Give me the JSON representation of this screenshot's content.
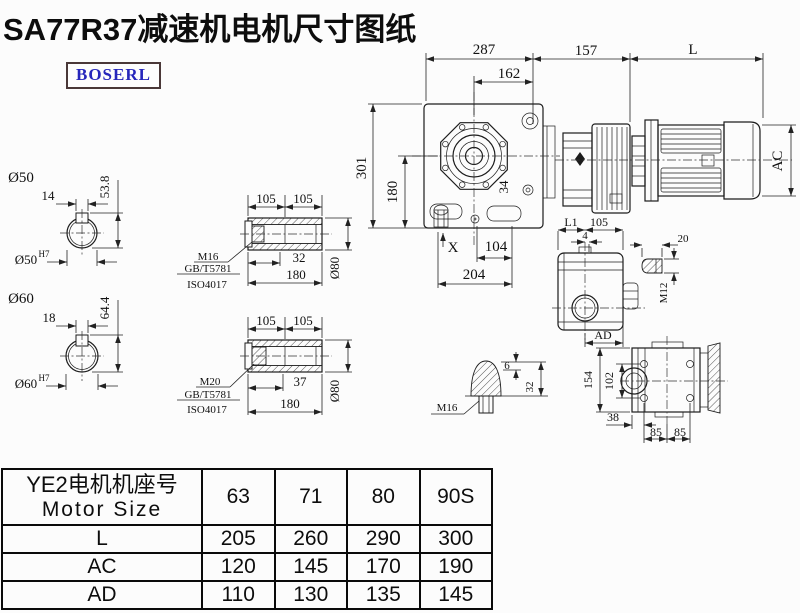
{
  "title": "SA77R37减速机电机尺寸图纸",
  "brand": {
    "name": "BOSERL"
  },
  "colors": {
    "line": "#1c1c1c",
    "brand_text": "#2626bb",
    "brand_border": "#4a3838",
    "background": "#fcfcfc"
  },
  "main_view": {
    "dim_top_total": "287",
    "dim_top_inner": "162",
    "dim_adapter": "157",
    "dim_motor_length": "L",
    "dim_height_total": "301",
    "dim_height_axis": "180",
    "dim_bore": "34",
    "marker_x": "X",
    "dim_bottom_inner": "104",
    "dim_bottom_total": "204",
    "dim_motor_diameter": "AC"
  },
  "shaft_50": {
    "label": "Ø50",
    "key_width": "14",
    "key_depth": "53.8",
    "bore_label": "Ø50",
    "bore_tolerance": "H7"
  },
  "shaft_60": {
    "label": "Ø60",
    "key_width": "18",
    "key_depth": "64.4",
    "bore_label": "Ø60",
    "bore_tolerance": "H7"
  },
  "hollow_shaft_top": {
    "dim_left": "105",
    "dim_right": "105",
    "dim_depth": "32",
    "dim_length": "180",
    "dim_diameter": "Ø80",
    "bolt": "M16",
    "standard_gb": "GB/T5781",
    "standard_iso": "ISO4017"
  },
  "hollow_shaft_bottom": {
    "dim_left": "105",
    "dim_right": "105",
    "dim_depth": "37",
    "dim_length": "180",
    "dim_diameter": "Ø80",
    "bolt": "M20",
    "standard_gb": "GB/T5781",
    "standard_iso": "ISO4017"
  },
  "side_view": {
    "dim_l1": "L1",
    "dim_105": "105",
    "dim_4": "4",
    "dim_ad": "AD"
  },
  "plug_detail": {
    "dim_length": "20",
    "thread": "M12"
  },
  "breather_detail": {
    "thread": "M16",
    "dim_6": "6",
    "dim_32": "32"
  },
  "rear_view": {
    "dim_height": "154",
    "dim_bolt_v": "102",
    "dim_38": "38",
    "dim_85a": "85",
    "dim_85b": "85"
  },
  "table": {
    "header_cn": "YE2电机机座号",
    "header_en": "Motor Size",
    "sizes": [
      "63",
      "71",
      "80",
      "90S"
    ],
    "rows": [
      {
        "label": "L",
        "values": [
          "205",
          "260",
          "290",
          "300"
        ]
      },
      {
        "label": "AC",
        "values": [
          "120",
          "145",
          "170",
          "190"
        ]
      },
      {
        "label": "AD",
        "values": [
          "110",
          "130",
          "135",
          "145"
        ]
      }
    ]
  }
}
